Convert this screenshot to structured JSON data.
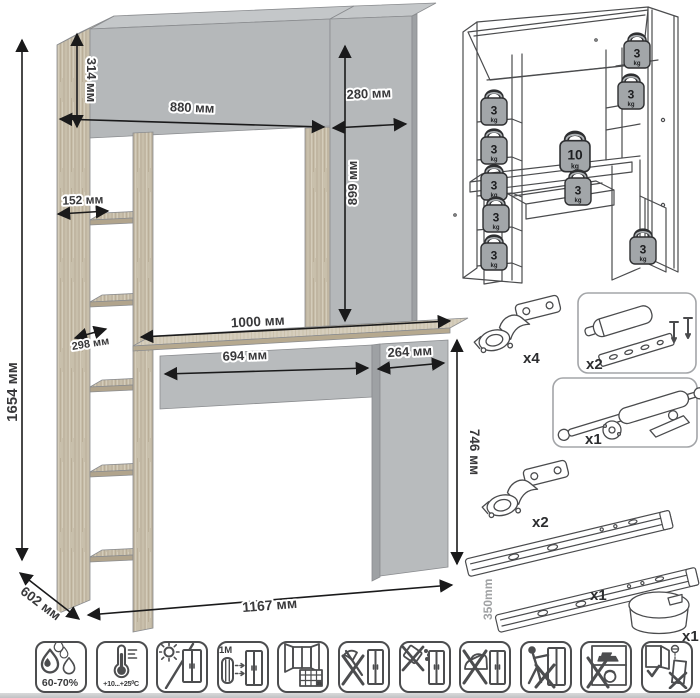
{
  "palette": {
    "wood": "#c8bfab",
    "wood_dark": "#b1a48c",
    "panel_gray": "#b5b8ba",
    "panel_dark": "#9ea1a4",
    "dim_line": "#1a1a1b",
    "sketch_line": "#4b4c4e"
  },
  "main_drawing": {
    "dimensions": {
      "total_height": "1654 мм",
      "hutch_height": "314 мм",
      "hutch_width": "880 мм",
      "top_right_width": "280 мм",
      "right_column_height": "899 мм",
      "shelf_width": "152 мм",
      "shelf_depth": "298 мм",
      "desktop_width": "1000 мм",
      "drawer_width": "694 мм",
      "cabinet_width": "264 мм",
      "cabinet_height": "746 мм",
      "depth": "602 мм",
      "total_width": "1167 мм"
    }
  },
  "load_diagram": {
    "weights": [
      {
        "value": "3",
        "unit": "kg",
        "location": "left-shelf-1"
      },
      {
        "value": "3",
        "unit": "kg",
        "location": "left-shelf-2"
      },
      {
        "value": "3",
        "unit": "kg",
        "location": "left-shelf-3"
      },
      {
        "value": "3",
        "unit": "kg",
        "location": "left-shelf-4"
      },
      {
        "value": "3",
        "unit": "kg",
        "location": "left-shelf-5"
      },
      {
        "value": "3",
        "unit": "kg",
        "location": "top-cabinet"
      },
      {
        "value": "3",
        "unit": "kg",
        "location": "right-shelf"
      },
      {
        "value": "10",
        "unit": "kg",
        "location": "desktop"
      },
      {
        "value": "3",
        "unit": "kg",
        "location": "drawer"
      },
      {
        "value": "3",
        "unit": "kg",
        "location": "lower-cabinet"
      }
    ]
  },
  "hardware": {
    "items": [
      {
        "name": "concealed-hinge",
        "qty": "x4"
      },
      {
        "name": "soft-close-damper",
        "qty": "x2"
      },
      {
        "name": "gas-lift",
        "qty": "x1"
      },
      {
        "name": "concealed-hinge",
        "qty": "x2"
      },
      {
        "name": "ball-bearing-slides",
        "qty": "x1",
        "length": "350mm"
      },
      {
        "name": "cable-grommet",
        "qty": "x1"
      }
    ]
  },
  "care_icons": [
    {
      "name": "humidity",
      "label": "60-70%"
    },
    {
      "name": "temperature",
      "label": "+10...+25⁰C"
    },
    {
      "name": "no-direct-sunlight",
      "label": ""
    },
    {
      "name": "radiator-distance",
      "label": "≥1М"
    },
    {
      "name": "acclimatization",
      "label": "25"
    },
    {
      "name": "no-impact",
      "label": ""
    },
    {
      "name": "no-liquids",
      "label": ""
    },
    {
      "name": "no-hot-objects",
      "label": ""
    },
    {
      "name": "no-dragging",
      "label": ""
    },
    {
      "name": "no-overload",
      "label": ""
    },
    {
      "name": "anti-tip-mounting",
      "label": ""
    }
  ]
}
